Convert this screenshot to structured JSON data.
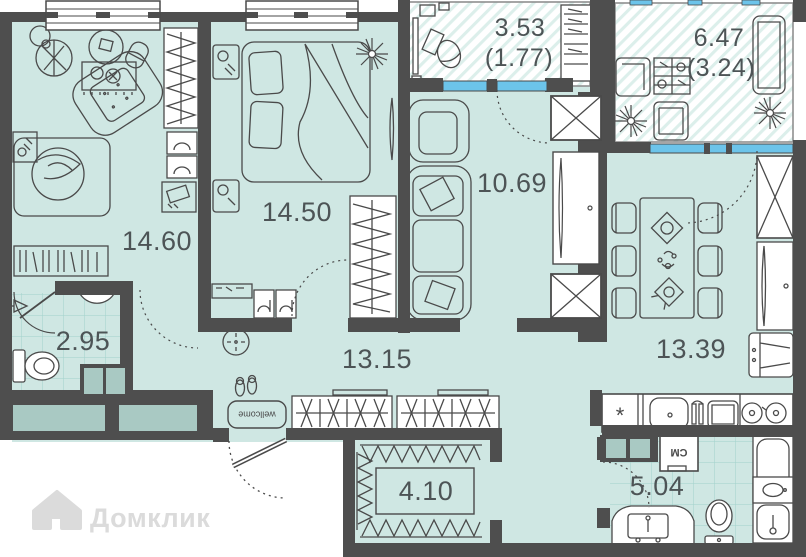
{
  "plan": {
    "watermark": {
      "brand": "Домклик"
    },
    "rooms": [
      {
        "id": "living-room",
        "area": "14.60"
      },
      {
        "id": "bedroom",
        "area": "14.50"
      },
      {
        "id": "balcony-small",
        "area": "3.53",
        "secondary": "(1.77)"
      },
      {
        "id": "balcony-large",
        "area": "6.47",
        "secondary": "(3.24)"
      },
      {
        "id": "lounge",
        "area": "10.69"
      },
      {
        "id": "kitchen-dining",
        "area": "13.39"
      },
      {
        "id": "bathroom-guest",
        "area": "2.95"
      },
      {
        "id": "hallway",
        "area": "13.15"
      },
      {
        "id": "walk-in-closet",
        "area": "4.10"
      },
      {
        "id": "bathroom-main",
        "area": "5.04"
      }
    ],
    "annotations": {
      "washer_label": "СМ",
      "doormat_label": "wellcome",
      "kitchen_symbol": "*"
    },
    "colors": {
      "wall": "#4e4e4e",
      "floor": "#cfe7e3",
      "window_glass": "#6cc4ea",
      "balcony_hatch": "#dcefeb",
      "tile_line": "#a2d2cb",
      "furniture_line": "#4a4a4a",
      "duct_fill": "#a9c9c3",
      "label_text": "#4d5456",
      "watermark": "#dbdbdb"
    }
  }
}
